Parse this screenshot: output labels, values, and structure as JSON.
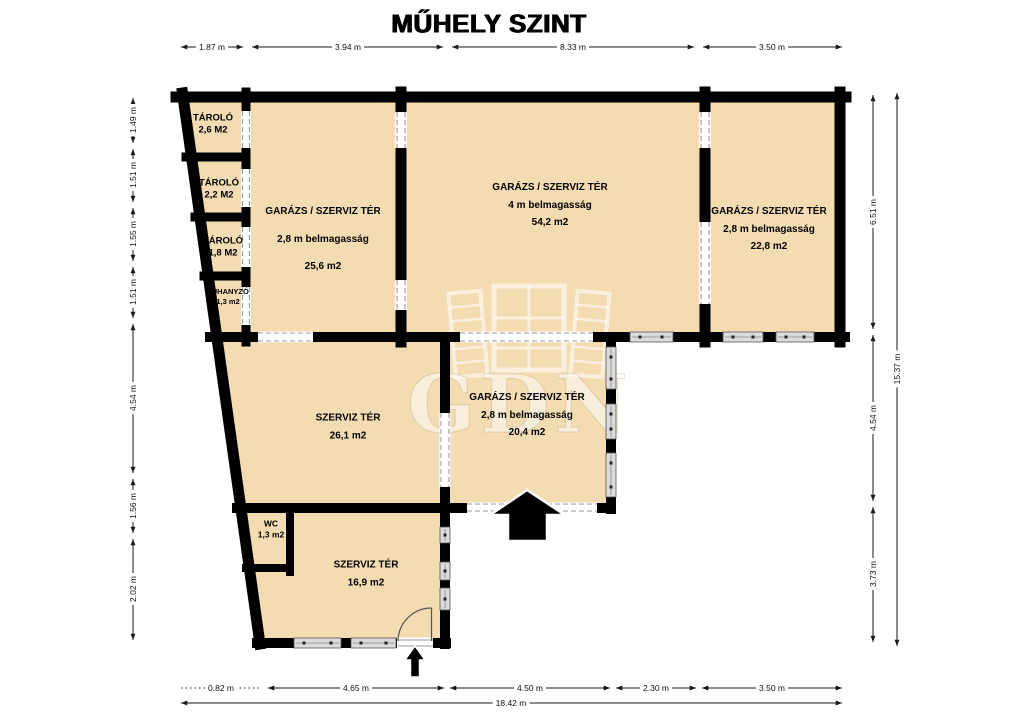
{
  "title": "MŰHELY SZINT",
  "watermark_text": "GDN",
  "colors": {
    "room_fill": "#f3dcb2",
    "wall": "#000000",
    "window": "#dcdcdc"
  },
  "icons": {
    "main_entrance_arrow": "up-arrow",
    "side_entrance_arrow": "up-arrow",
    "door_swing": "quarter-arc"
  },
  "rooms": [
    {
      "name": "TÁROLÓ",
      "area": "2,6 M2"
    },
    {
      "name": "TÁROLÓ",
      "area": "2,2 M2"
    },
    {
      "name": "TÁROLÓ",
      "area": "1,8 M2"
    },
    {
      "name": "ZUHANYZÓ",
      "area": "1,3 m2"
    },
    {
      "name": "GARÁZS / SZERVIZ TÉR",
      "height": "2,8 m belmagasság",
      "area": "25,6 m2"
    },
    {
      "name": "GARÁZS / SZERVIZ TÉR",
      "height": "4 m belmagasság",
      "area": "54,2 m2"
    },
    {
      "name": "GARÁZS / SZERVIZ TÉR",
      "height": "2,8 m belmagasság",
      "area": "22,8 m2"
    },
    {
      "name": "SZERVIZ TÉR",
      "area": "26,1 m2"
    },
    {
      "name": "GARÁZS / SZERVIZ TÉR",
      "height": "2,8 m belmagasság",
      "area": "20,4 m2"
    },
    {
      "name": "WC",
      "area": "1,3 m2"
    },
    {
      "name": "SZERVIZ TÉR",
      "area": "16,9 m2"
    }
  ],
  "dimensions": {
    "top": [
      "1.87 m",
      "3.94 m",
      "8.33 m",
      "3.50 m"
    ],
    "left": [
      "1.49 m",
      "1.51 m",
      "1.55 m",
      "1.51 m",
      "4.54 m",
      "1.56 m",
      "2.02 m"
    ],
    "right": [
      "6.51 m",
      "4.54 m",
      "3.73 m"
    ],
    "right_total": "15.37 m",
    "bottom": [
      "0.82 m",
      "4.65 m",
      "4.50 m",
      "2.30 m",
      "3.50 m"
    ],
    "bottom_total": "18.42 m"
  }
}
